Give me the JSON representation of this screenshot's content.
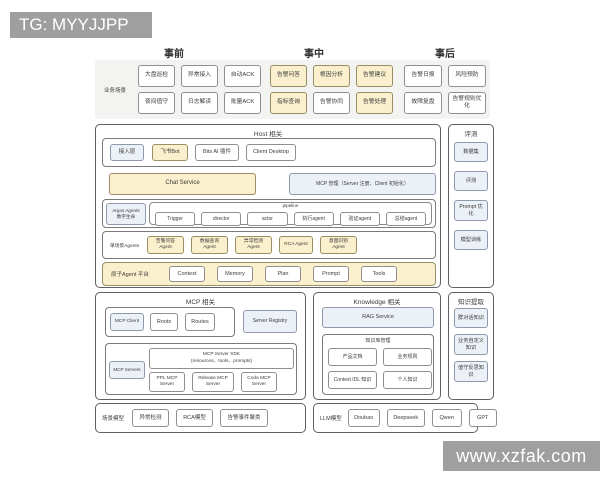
{
  "watermark_tg": "TG: MYYJJPP",
  "watermark_site": "www.xzfak.com",
  "phases": {
    "pre": "事前",
    "mid": "事中",
    "post": "事后"
  },
  "scenarios": {
    "label": "业务场景",
    "pre": [
      "大盘巡检",
      "异常接入",
      "自动ACK",
      "夜间值守",
      "日志解读",
      "批量ACK"
    ],
    "mid": [
      "告警问答",
      "根因分析",
      "告警建议",
      "指标查询",
      "告警协同",
      "告警处理"
    ],
    "post": [
      "告警日报",
      "风险预防",
      "故障复盘",
      "告警规则优化"
    ]
  },
  "host": {
    "title": "Host 相关",
    "access_label": "接入层",
    "access_items": [
      "飞书Bot",
      "Bits AI 插件",
      "Client Desktop"
    ],
    "chat_service": "Chat Service",
    "mcp_mgmt": "MCP 管理（Server 注册、Client 初始化）",
    "agents_label_1": "Argos Agents",
    "agents_label_2": "数字生命",
    "pipeline_title": "pipeline",
    "pipeline_items": [
      "Trigger",
      "director",
      "actor",
      "执行agent",
      "验证agent",
      "总结agent"
    ],
    "single_label": "单场景Agents",
    "single_items": [
      "告警问答Agent",
      "数据查询Agent",
      "异常检测Agent",
      "RCA Agent",
      "意图识别Agent"
    ],
    "atomic_label": "原子Agent 平台",
    "atomic_items": [
      "Context",
      "Memory",
      "Plan",
      "Prompt",
      "Tools"
    ]
  },
  "evaluation": {
    "title": "评测",
    "items": [
      "数据集",
      "评测",
      "Prompt 优化",
      "模型训练"
    ]
  },
  "mcp": {
    "title": "MCP 相关",
    "client_label": "MCP Client",
    "client_items": [
      "Roots",
      "Routes"
    ],
    "server_registry": "Server Registry",
    "servers_label": "MCP Servers",
    "sdk_line1": "MCP Server SDK",
    "sdk_line2": "(resources、tools、prompts)",
    "server_items": [
      "PPL MCP Server",
      "Release MCP Server",
      "Code MCP Server"
    ]
  },
  "knowledge": {
    "title": "Knowledge 相关",
    "rag": "RAG Service",
    "kb_title": "知识库管理",
    "kb_items": [
      "产品文档",
      "业务规则",
      "Context IDL 知识",
      "个人知识"
    ]
  },
  "extraction": {
    "title": "知识提取",
    "items": [
      "群对话知识",
      "业务自定义知识",
      "值守反思知识"
    ]
  },
  "scene_models": {
    "label": "场景模型",
    "items": [
      "异常检测",
      "RCA模型",
      "告警事件聚类"
    ]
  },
  "llm": {
    "label": "LLM模型",
    "items": [
      "Doubao",
      "Deepseek",
      "Qwen",
      "GPT"
    ]
  },
  "colors": {
    "highlight_yellow": "#faf0cd",
    "panel_blue": "#ecf0f7",
    "watermark_gray": "#9f9f9f",
    "band_gray": "#f3f3f1"
  }
}
